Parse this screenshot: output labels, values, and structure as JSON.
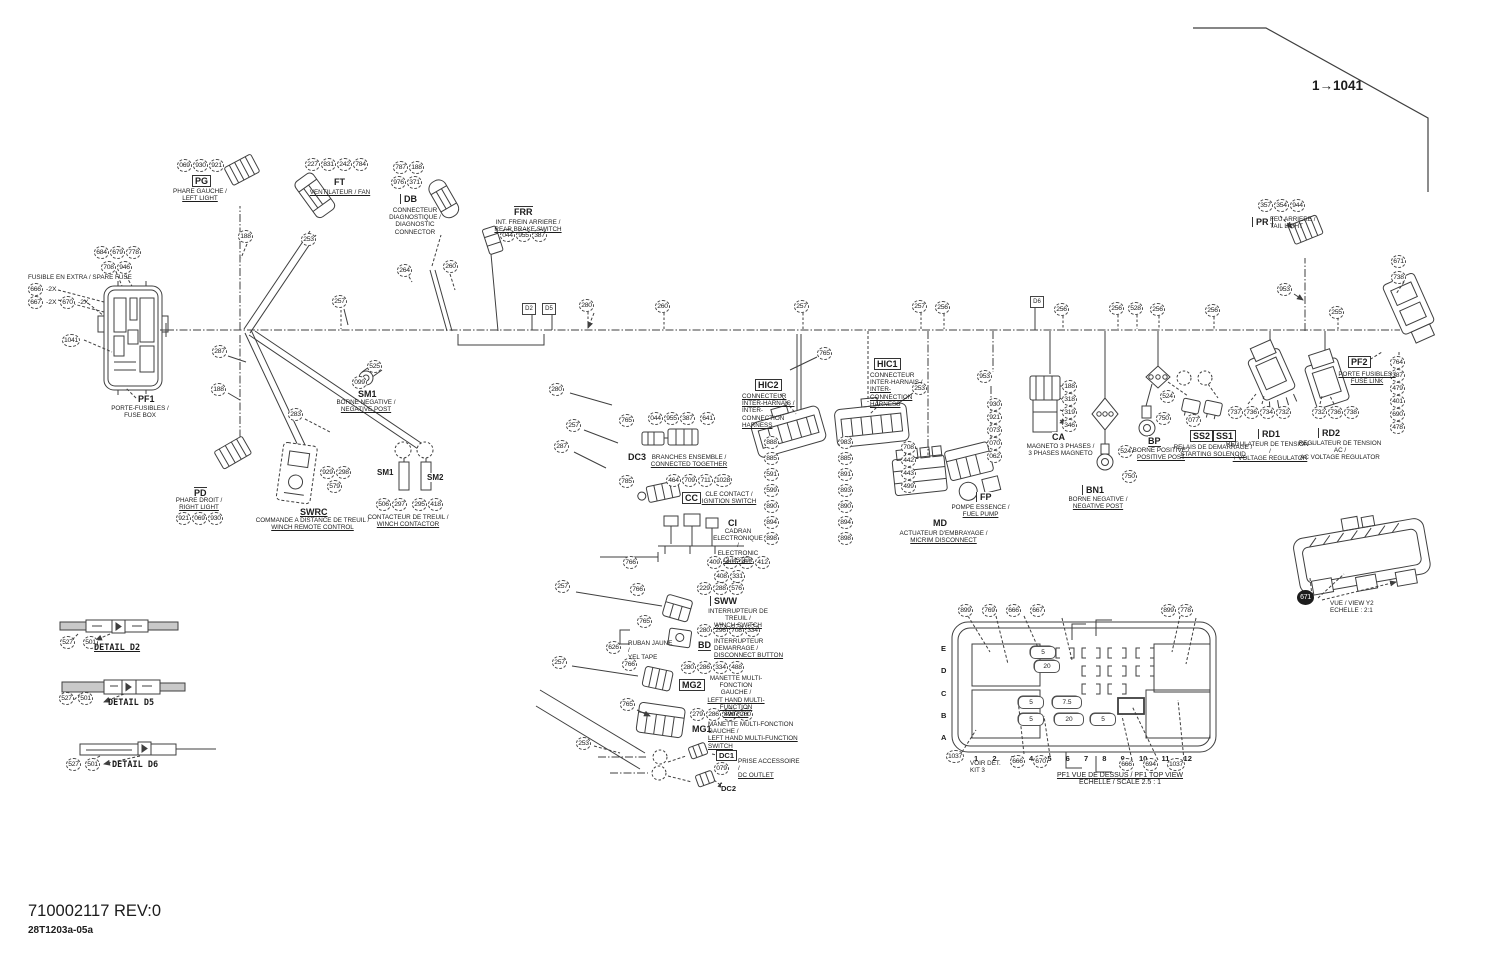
{
  "page": {
    "corner_ref": "1→1041",
    "part_number": "710002117 REV:0",
    "doc_code": "28T1203a-05a"
  },
  "components": {
    "pg": {
      "tag": "PG",
      "l1": "PHARE GAUCHE /",
      "l2": "LEFT LIGHT",
      "chips": [
        "069",
        "930",
        "921"
      ]
    },
    "ft": {
      "tag": "FT",
      "l1": "VENTILATEUR / FAN",
      "chips": [
        "227",
        "831",
        "242",
        "784"
      ]
    },
    "db": {
      "tag": "DB",
      "l1": "CONNECTEUR",
      "l2": "DIAGNOSTIQUE /",
      "l3": "DIAGNOSTIC",
      "l4": "CONNECTOR",
      "chips1": [
        "787",
        "188"
      ],
      "chips2": [
        "976",
        "371"
      ]
    },
    "frr": {
      "tag": "FRR",
      "l1": "INT. FREIN ARRIERE /",
      "l2": "REAR BRAKE SWITCH",
      "chips": [
        "044",
        "955",
        "387"
      ]
    },
    "pf1": {
      "tag": "PF1",
      "l1": "PORTE-FUSIBLES /",
      "l2": "FUSE BOX",
      "chips1": [
        "684",
        "679",
        "778"
      ],
      "chips2": [
        "708",
        "946"
      ],
      "chip_left": "1041",
      "spare_note": "FUSIBLE EN EXTRA / SPARE FUSE",
      "spare_chips": [
        {
          "c": "666",
          "s": "-2X"
        },
        {
          "c": "667",
          "s": "-2X"
        },
        {
          "c": "670",
          "s": "-2X"
        }
      ]
    },
    "pd": {
      "tag": "PD",
      "l1": "PHARE DROIT /",
      "l2": "RIGHT LIGHT",
      "chips": [
        "921",
        "069",
        "930"
      ]
    },
    "swrc": {
      "tag": "SWRC",
      "l1": "COMMANDE A DISTANCE DE TREUIL /",
      "l2": "WINCH REMOTE CONTROL",
      "chips1": [
        "929",
        "298"
      ],
      "chips2": [
        "579"
      ]
    },
    "sm_neg": {
      "tag": "SM1",
      "l1": "BORNE NEGATIVE /",
      "l2": "NEGATIVE POST",
      "chip1": "525",
      "chip2": "099"
    },
    "winch": {
      "tag1": "SM1",
      "tag2": "SM2",
      "l1": "CONTACTEUR DE TREUIL /",
      "l2": "WINCH CONTACTOR",
      "chips1": [
        "506",
        "297"
      ],
      "chips2": [
        "295",
        "418"
      ]
    },
    "dc3": {
      "tag": "DC3",
      "l1": "BRANCHES ENSEMBLE /",
      "l2": "CONNECTED TOGETHER",
      "chips": [
        "044",
        "955",
        "387"
      ],
      "chip_r": "641"
    },
    "cc": {
      "tag": "CC",
      "l1": "CLE CONTACT /",
      "l2": "IGNITION SWITCH",
      "chips": [
        "464",
        "709",
        "711",
        "1028"
      ]
    },
    "ci": {
      "tag": "CI",
      "l1": "CADRAN",
      "l2": "ELECTRONIQUE /",
      "l3": "ELECTRONIC",
      "l4": "CLUSTER",
      "chips1": [
        "409",
        "410",
        "411",
        "412"
      ],
      "chips2": [
        "408",
        "331"
      ]
    },
    "sww": {
      "tag": "SWW",
      "l1": "INTERRUPTEUR DE TREUIL /",
      "l2": "WINCH SWITCH",
      "chips": [
        "229",
        "288",
        "576"
      ]
    },
    "bd": {
      "tag": "BD",
      "l1": "INTERRUPTEUR DEMARRAGE /",
      "l2": "DISCONNECT BUTTON",
      "chips": [
        "280",
        "296",
        "708",
        "334"
      ]
    },
    "tape": {
      "chip": "626",
      "l1": "RUBAN JAUNE /",
      "l2": "YEL TAPE"
    },
    "mg2": {
      "tag": "MG2",
      "l1": "MANETTE MULTI-FONCTION",
      "l2": "GAUCHE /",
      "l3": "LEFT HAND MULTI-FUNCTION",
      "l4": "SWITCH",
      "chips": [
        "280",
        "286",
        "334",
        "488"
      ]
    },
    "mg1": {
      "tag": "MG1",
      "l1": "MANETTE MULTI-FONCTION GAUCHE /",
      "l2": "LEFT HAND MULTI-FUNCTION SWITCH",
      "chips": [
        "279",
        "286",
        "499",
        "700"
      ]
    },
    "dc1": {
      "tag": "DC1",
      "tag2": "DC2",
      "l1": "PRISE ACCESSOIRE /",
      "l2": "DC OUTLET",
      "chip": "079"
    },
    "hic2": {
      "tag": "HIC2",
      "l1": "CONNECTEUR",
      "l2": "INTER-HARNAIS /",
      "l3": "INTER-",
      "l4": "CONNECTION",
      "l5": "HARNESS",
      "chain": [
        "888",
        "885",
        "591",
        "599",
        "890",
        "894",
        "898"
      ]
    },
    "hic1": {
      "tag": "HIC1",
      "l1": "CONNECTEUR",
      "l2": "INTER-HARNAIS /",
      "l3": "INTER-",
      "l4": "CONNECTION",
      "l5": "HARNESS",
      "chain": [
        "983",
        "885",
        "891",
        "893",
        "890",
        "894",
        "898"
      ]
    },
    "md": {
      "tag": "MD",
      "l1": "ACTUATEUR D'EMBRAYAGE /",
      "l2": "MICRIM DISCONNECT",
      "chain": [
        "708",
        "442",
        "443",
        "499"
      ]
    },
    "fp": {
      "tag": "FP",
      "l1": "POMPE ESSENCE /",
      "l2": "FUEL PUMP",
      "chip_top": "953",
      "chain": [
        "930",
        "921",
        "073",
        "070",
        "062"
      ]
    },
    "ca": {
      "tag": "CA",
      "l1": "MAGNETO 3 PHASES /",
      "l2": "3 PHASES MAGNETO",
      "chain": [
        "188",
        "318",
        "319",
        "346"
      ]
    },
    "bn1": {
      "tag": "BN1",
      "l1": "BORNE NEGATIVE /",
      "l2": "NEGATIVE POST",
      "chip1": "524",
      "chip2": "750"
    },
    "bp": {
      "tag": "BP",
      "l1": "BORNE POSITIVE /",
      "l2": "POSITIVE POST",
      "chip1": "524",
      "chip2": "750"
    },
    "ss": {
      "tag1": "SS2",
      "tag2": "SS1",
      "l1": "RELAIS DE DEMARRAGE /",
      "l2": "STARTING SOLENOID",
      "chip": "077"
    },
    "rd1": {
      "tag": "RD1",
      "l1": "REGULATEUR DE TENSION ~ /",
      "l2": "+ VOLTAGE REGULATOR",
      "chips": [
        "737",
        "736",
        "734",
        "732"
      ]
    },
    "rd2": {
      "tag": "RD2",
      "l1": "REGULATEUR DE TENSION AC /",
      "l2": "AC VOLTAGE REGULATOR",
      "chips": [
        "732",
        "736",
        "738"
      ]
    },
    "pr": {
      "tag": "PR",
      "l1": "FEU ARRIERE /",
      "l2": "TAIL LIGHT",
      "chips": [
        "357",
        "354",
        "944"
      ]
    },
    "pf2": {
      "tag": "PF2",
      "l1": "PORTE FUSIBLES /",
      "l2": "FUSE LINK",
      "chips_top": [
        "671",
        "738"
      ],
      "chain": [
        "764",
        "387",
        "479",
        "401",
        "690",
        "478"
      ]
    },
    "y2": {
      "chip": "671",
      "l1": "VUE / VIEW Y2",
      "l2": "ECHELLE : 2:1"
    }
  },
  "pf1top": {
    "rows": [
      "E",
      "D",
      "C",
      "B",
      "A"
    ],
    "cols": [
      "1",
      "2",
      "3",
      "4",
      "5",
      "6",
      "7",
      "8",
      "9",
      "10",
      "11",
      "12"
    ],
    "chips_top": [
      "899",
      "769",
      "666",
      "667"
    ],
    "chips_top_right": [
      "899",
      "778"
    ],
    "chip_bl": "1037",
    "note1": "VOIR DET.",
    "note2": "KIT 3",
    "chips_bottom": [
      "666",
      "670"
    ],
    "chips_bottom_right": [
      "666",
      "694",
      "1037"
    ],
    "fuses": [
      "5",
      "20",
      "5",
      "7.5",
      "5",
      "20",
      "5"
    ],
    "title": "PF1 VUE DE DESSUS / PF1 TOP VIEW",
    "subtitle": "ECHELLE / SCALE 2.5 : 1"
  },
  "details": {
    "d2": {
      "label": "DETAIL D2",
      "chips": [
        "527",
        "501"
      ]
    },
    "d5": {
      "label": "DETAIL D5",
      "chips": [
        "527",
        "501"
      ]
    },
    "d6": {
      "label": "DETAIL D6",
      "chips": [
        "527",
        "501"
      ]
    }
  },
  "bus_markers": [
    "D2",
    "D5",
    "D6"
  ],
  "wire_callouts": [
    "188",
    "253",
    "257",
    "287",
    "188",
    "283",
    "264",
    "260",
    "280",
    "260",
    "257",
    "257",
    "256",
    "256",
    "256",
    "528",
    "256",
    "256",
    "255",
    "953",
    "765",
    "253",
    "765",
    "785",
    "766",
    "766",
    "765",
    "766",
    "765",
    "253",
    "280",
    "257",
    "287",
    "257",
    "257"
  ]
}
